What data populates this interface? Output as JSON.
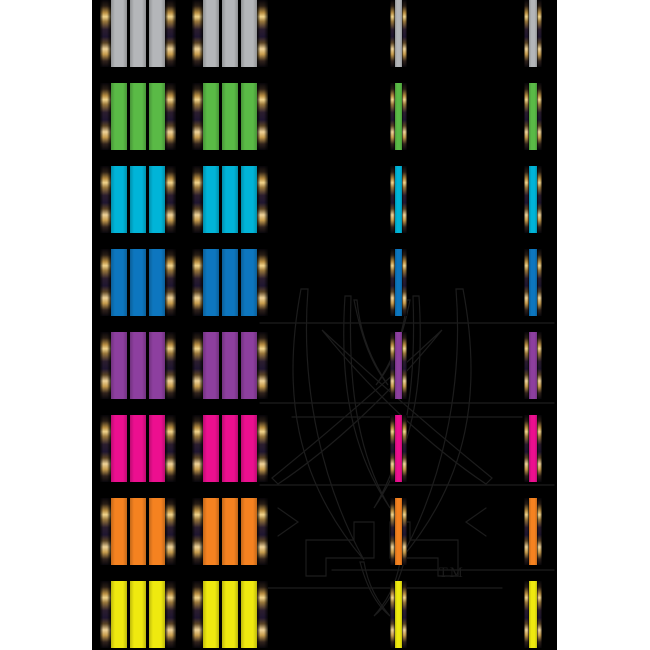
{
  "page": {
    "background": "#ffffff"
  },
  "board": {
    "background": "#000000",
    "gold_trim": "#e9c97e",
    "rows_count": 8,
    "columns": [
      "ribbon-panel-wide",
      "ribbon-panel-wide",
      "ribbon-strip-thin",
      "ribbon-strip-thin"
    ]
  },
  "rows": [
    {
      "name": "silver",
      "hex": "#b4b6b9"
    },
    {
      "name": "green",
      "hex": "#5aba46"
    },
    {
      "name": "cyan",
      "hex": "#00b4d8"
    },
    {
      "name": "blue",
      "hex": "#0d76bf"
    },
    {
      "name": "purple",
      "hex": "#8d3f9f"
    },
    {
      "name": "magenta",
      "hex": "#ec0f8f"
    },
    {
      "name": "orange",
      "hex": "#f58220"
    },
    {
      "name": "yellow",
      "hex": "#efe90f"
    }
  ],
  "watermark": {
    "tm_label": "TM",
    "line_color": "#1c1c1c"
  }
}
